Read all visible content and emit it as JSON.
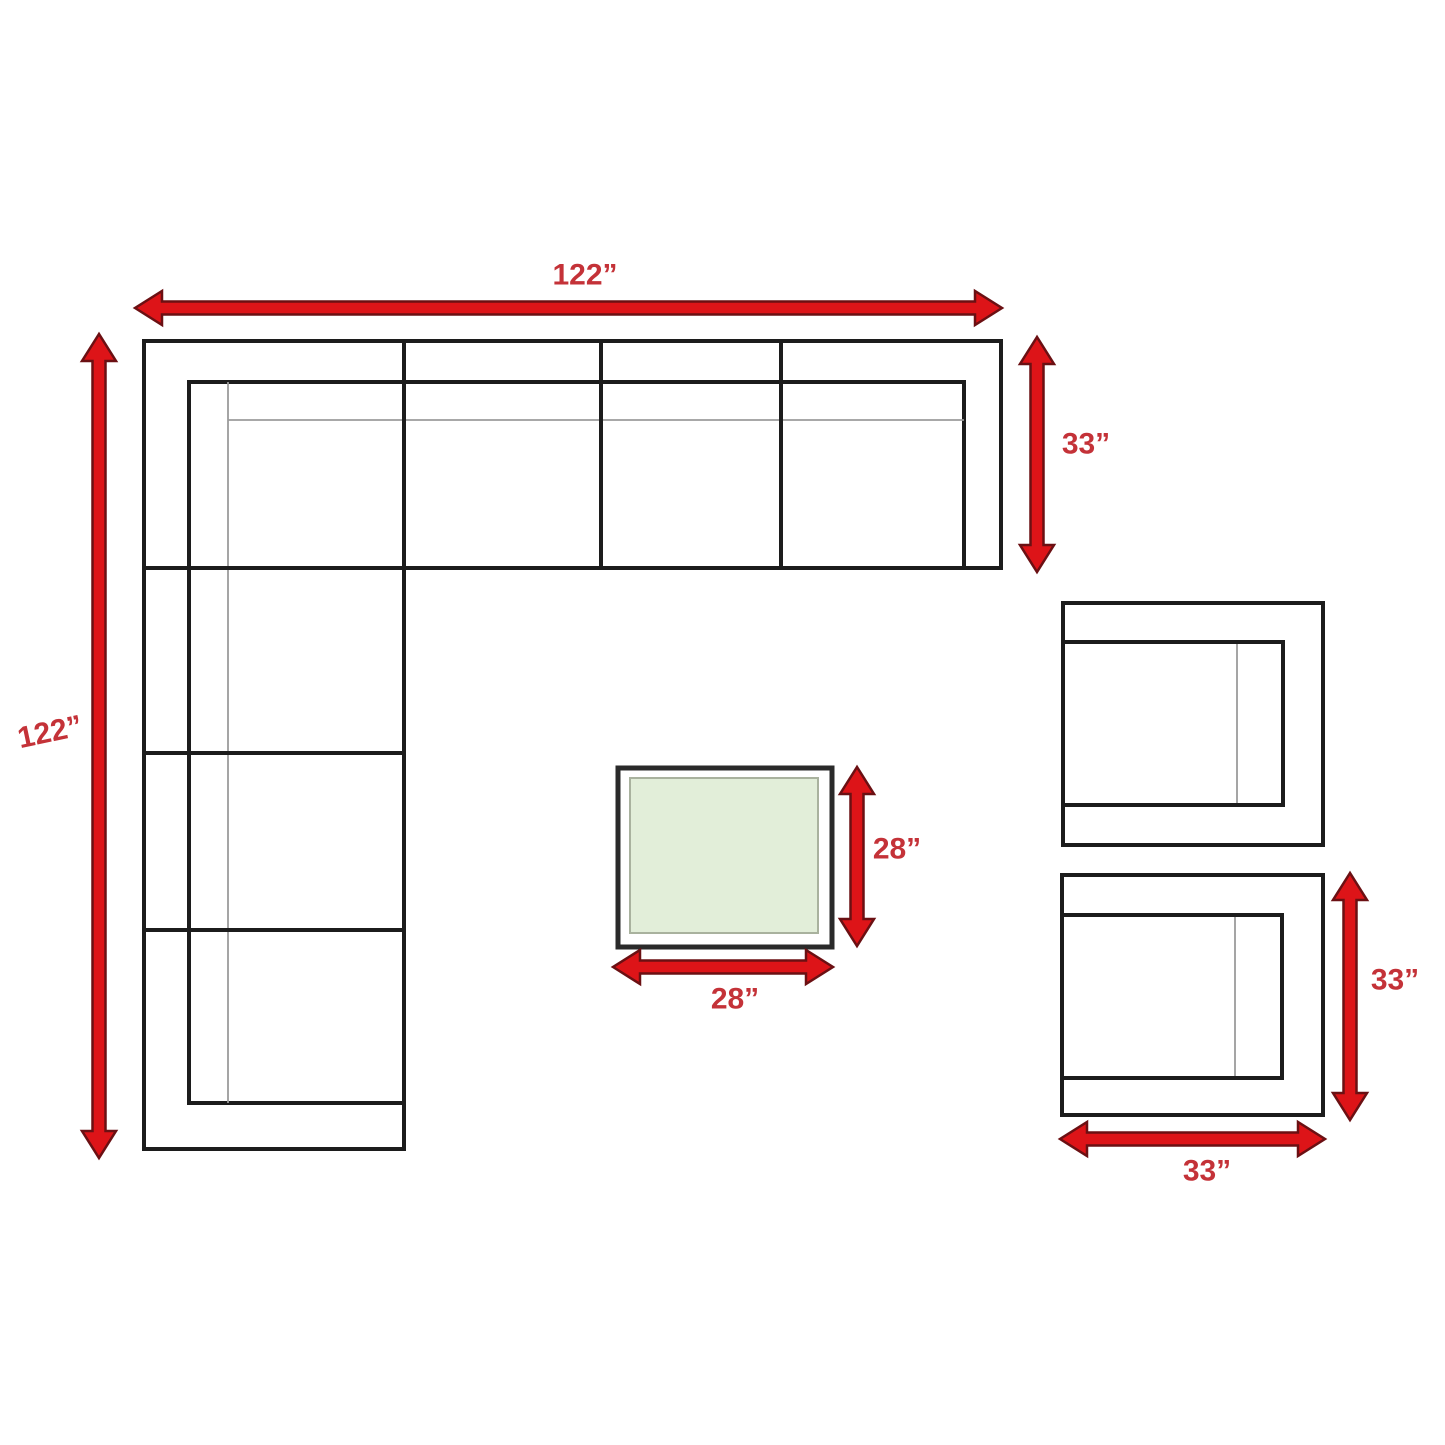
{
  "canvas": {
    "width": 1445,
    "height": 1445,
    "background": "#ffffff"
  },
  "style": {
    "line_color": "#1c1c1c",
    "line_width": 4,
    "thin_line_color": "#9b9b9b",
    "thin_line_width": 1.8,
    "arrow_fill": "#dd1418",
    "arrow_stroke": "#6b1013",
    "arrow_stroke_width": 2.5,
    "arrow_shaft_half": 6.5,
    "arrow_head_length": 27,
    "arrow_head_half_width": 17,
    "label_color": "#c43238",
    "label_font_size": 30,
    "table_fill": "#e2eed9",
    "table_border_color": "#2a2a2a",
    "table_border_width": 5,
    "table_inner_border_color": "#a9b29e",
    "table_inner_border_width": 2
  },
  "furniture": {
    "sectional_sofa": {
      "description": "L-shaped sectional sofa, top view",
      "outer_outline_points": [
        [
          144,
          341
        ],
        [
          1001,
          341
        ],
        [
          1001,
          568
        ],
        [
          404,
          568
        ],
        [
          404,
          1149
        ],
        [
          144,
          1149
        ]
      ],
      "backrest_inline_points": [
        [
          404,
          1103
        ],
        [
          189,
          1103
        ],
        [
          189,
          382
        ],
        [
          964,
          382
        ],
        [
          964,
          568
        ]
      ],
      "cushion_lines": [
        [
          [
            228,
            382
          ],
          [
            228,
            1103
          ]
        ],
        [
          [
            228,
            420
          ],
          [
            964,
            420
          ]
        ]
      ],
      "seat_dividers": [
        [
          [
            404,
            341
          ],
          [
            404,
            568
          ]
        ],
        [
          [
            601,
            341
          ],
          [
            601,
            568
          ]
        ],
        [
          [
            781,
            341
          ],
          [
            781,
            568
          ]
        ],
        [
          [
            144,
            568
          ],
          [
            404,
            568
          ]
        ],
        [
          [
            144,
            753
          ],
          [
            404,
            753
          ]
        ],
        [
          [
            144,
            930
          ],
          [
            404,
            930
          ]
        ]
      ]
    },
    "coffee_table": {
      "description": "Square coffee table with glass top, top view",
      "outer_rect": [
        618,
        768,
        832,
        947
      ],
      "glass_rect": [
        630,
        778,
        818,
        933
      ]
    },
    "armchairs": [
      {
        "description": "Armchair 1, top view, facing right",
        "outer_rect": [
          1063,
          603,
          1323,
          845
        ],
        "seat_rect": [
          1063,
          642,
          1283,
          805
        ],
        "cushion_line_x": 1237
      },
      {
        "description": "Armchair 2, top view, facing right",
        "outer_rect": [
          1062,
          875,
          1323,
          1115
        ],
        "seat_rect": [
          1062,
          915,
          1282,
          1078
        ],
        "cushion_line_x": 1235
      }
    ]
  },
  "dimension_callouts": [
    {
      "id": "sofa-width",
      "label": "122”",
      "orientation": "horizontal",
      "from": [
        135,
        308
      ],
      "to": [
        1002,
        308
      ],
      "label_pos": [
        585,
        274
      ],
      "label_rotation": 0
    },
    {
      "id": "sofa-height",
      "label": "122”",
      "orientation": "vertical",
      "from": [
        99,
        334
      ],
      "to": [
        99,
        1158
      ],
      "label_pos": [
        52,
        731
      ],
      "label_rotation": -12
    },
    {
      "id": "sofa-depth",
      "label": "33”",
      "orientation": "vertical",
      "from": [
        1037,
        337
      ],
      "to": [
        1037,
        572
      ],
      "label_pos": [
        1086,
        443
      ],
      "label_rotation": 0
    },
    {
      "id": "table-depth",
      "label": "28”",
      "orientation": "vertical",
      "from": [
        857,
        767
      ],
      "to": [
        857,
        946
      ],
      "label_pos": [
        897,
        848
      ],
      "label_rotation": 0
    },
    {
      "id": "table-width",
      "label": "28”",
      "orientation": "horizontal",
      "from": [
        613,
        967
      ],
      "to": [
        833,
        967
      ],
      "label_pos": [
        735,
        998
      ],
      "label_rotation": 0
    },
    {
      "id": "chair-depth",
      "label": "33”",
      "orientation": "vertical",
      "from": [
        1350,
        873
      ],
      "to": [
        1350,
        1120
      ],
      "label_pos": [
        1395,
        979
      ],
      "label_rotation": 0
    },
    {
      "id": "chair-width",
      "label": "33”",
      "orientation": "horizontal",
      "from": [
        1060,
        1139
      ],
      "to": [
        1325,
        1139
      ],
      "label_pos": [
        1207,
        1170
      ],
      "label_rotation": 0
    }
  ]
}
